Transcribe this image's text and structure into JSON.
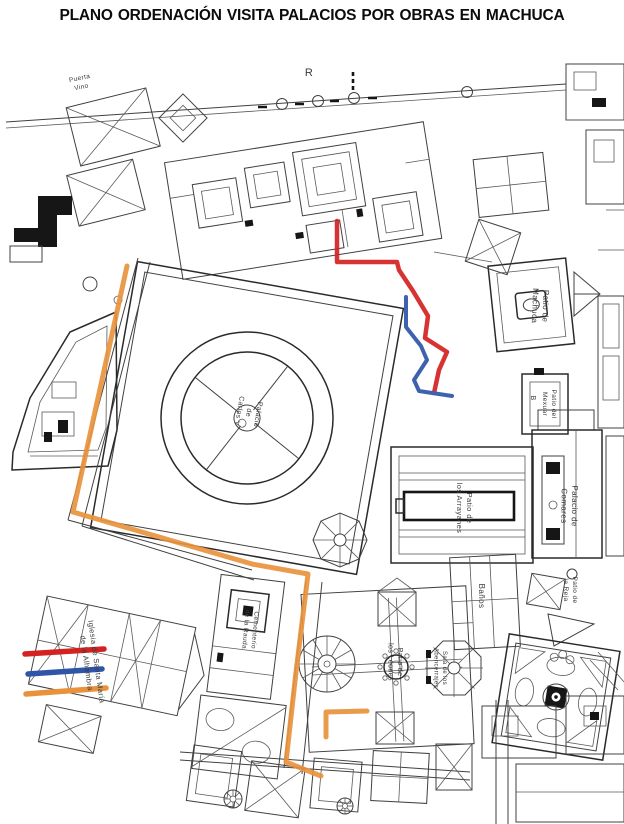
{
  "title": "PLANO ORDENACIÓN VISITA PALACIOS POR OBRAS EN MACHUCA",
  "map": {
    "labels": [
      {
        "id": "palacio-carlos-v",
        "lines": [
          "Palacio",
          "de",
          "Carlos V"
        ],
        "x": 256,
        "y": 414,
        "rotate": 100,
        "size": 7
      },
      {
        "id": "letra-r",
        "lines": [
          "R"
        ],
        "x": 309,
        "y": 76,
        "rotate": 0,
        "size": 11
      },
      {
        "id": "puerta-vino",
        "lines": [
          "Puerta",
          "Vino"
        ],
        "x": 80,
        "y": 80,
        "rotate": -12,
        "size": 6.5
      },
      {
        "id": "patio-de-machuca",
        "lines": [
          "Patio de",
          "Machuca"
        ],
        "x": 543,
        "y": 306,
        "rotate": 92,
        "size": 8
      },
      {
        "id": "letra-b",
        "lines": [
          "B"
        ],
        "x": 531,
        "y": 398,
        "rotate": 90,
        "size": 7
      },
      {
        "id": "patio-del-mexuar",
        "lines": [
          "Patio del",
          "Mexuar"
        ],
        "x": 552,
        "y": 404,
        "rotate": 90,
        "size": 6.5
      },
      {
        "id": "palacio-de-comares",
        "lines": [
          "Palacio de",
          "Comares"
        ],
        "x": 572,
        "y": 506,
        "rotate": 91,
        "size": 8
      },
      {
        "id": "patio-de-los-arrayanes",
        "lines": [
          "Patio de",
          "los Arrayanes"
        ],
        "x": 467,
        "y": 508,
        "rotate": 90,
        "size": 7.5
      },
      {
        "id": "banos",
        "lines": [
          "Baños"
        ],
        "x": 479,
        "y": 596,
        "rotate": 90,
        "size": 8
      },
      {
        "id": "patio-de-la-reja",
        "lines": [
          "Patio de",
          "la Reja"
        ],
        "x": 573,
        "y": 590,
        "rotate": 90,
        "size": 6.5
      },
      {
        "id": "patio-de-los-leones",
        "lines": [
          "Patio de",
          "los Leones"
        ],
        "x": 398,
        "y": 662,
        "rotate": 90,
        "size": 7
      },
      {
        "id": "sala-de-los-abencerrajes",
        "lines": [
          "Sala de los",
          "Abencerrajes"
        ],
        "x": 443,
        "y": 668,
        "rotate": 90,
        "size": 6
      },
      {
        "id": "iglesia-santa-maria",
        "lines": [
          "Iglesia de Santa María",
          "de la Alhambra"
        ],
        "x": 94,
        "y": 662,
        "rotate": 82,
        "size": 7.5
      },
      {
        "id": "cementerio-rauda",
        "lines": [
          "Cementerio",
          "de la Rauda"
        ],
        "x": 253,
        "y": 630,
        "rotate": 95,
        "size": 6.5
      }
    ],
    "routes": [
      {
        "id": "itinerario-rojo",
        "color": "#d42222",
        "width": 4.5,
        "points": [
          [
            337,
            221
          ],
          [
            337,
            262
          ],
          [
            397,
            262
          ],
          [
            399,
            270
          ],
          [
            413,
            291
          ],
          [
            428,
            316
          ],
          [
            425,
            338
          ],
          [
            447,
            352
          ],
          [
            439,
            370
          ],
          [
            434,
            393
          ]
        ]
      },
      {
        "id": "itinerario-azul",
        "color": "#2f55a8",
        "width": 4,
        "points": [
          [
            406,
            297
          ],
          [
            406,
            327
          ],
          [
            421,
            346
          ],
          [
            427,
            360
          ],
          [
            414,
            380
          ],
          [
            419,
            391
          ],
          [
            452,
            396
          ]
        ]
      },
      {
        "id": "itinerario-naranja",
        "color": "#e8923c",
        "width": 5,
        "points": [
          [
            127,
            266
          ],
          [
            73,
            512
          ],
          [
            252,
            564
          ],
          [
            308,
            574
          ],
          [
            296,
            672
          ],
          [
            286,
            762
          ],
          [
            321,
            776
          ]
        ]
      },
      {
        "id": "itinerario-naranja-tramo",
        "color": "#e8923c",
        "width": 5,
        "points": [
          [
            326,
            737
          ],
          [
            326,
            712
          ],
          [
            367,
            711
          ]
        ]
      }
    ],
    "legend": {
      "items": [
        {
          "id": "linea-roja",
          "color": "#d42222",
          "x1": 25,
          "y1": 654,
          "x2": 104,
          "y2": 649
        },
        {
          "id": "linea-azul",
          "color": "#2f55a8",
          "x1": 28,
          "y1": 674,
          "x2": 102,
          "y2": 669
        },
        {
          "id": "linea-naranja",
          "color": "#e8923c",
          "x1": 26,
          "y1": 694,
          "x2": 106,
          "y2": 688
        }
      ]
    }
  }
}
